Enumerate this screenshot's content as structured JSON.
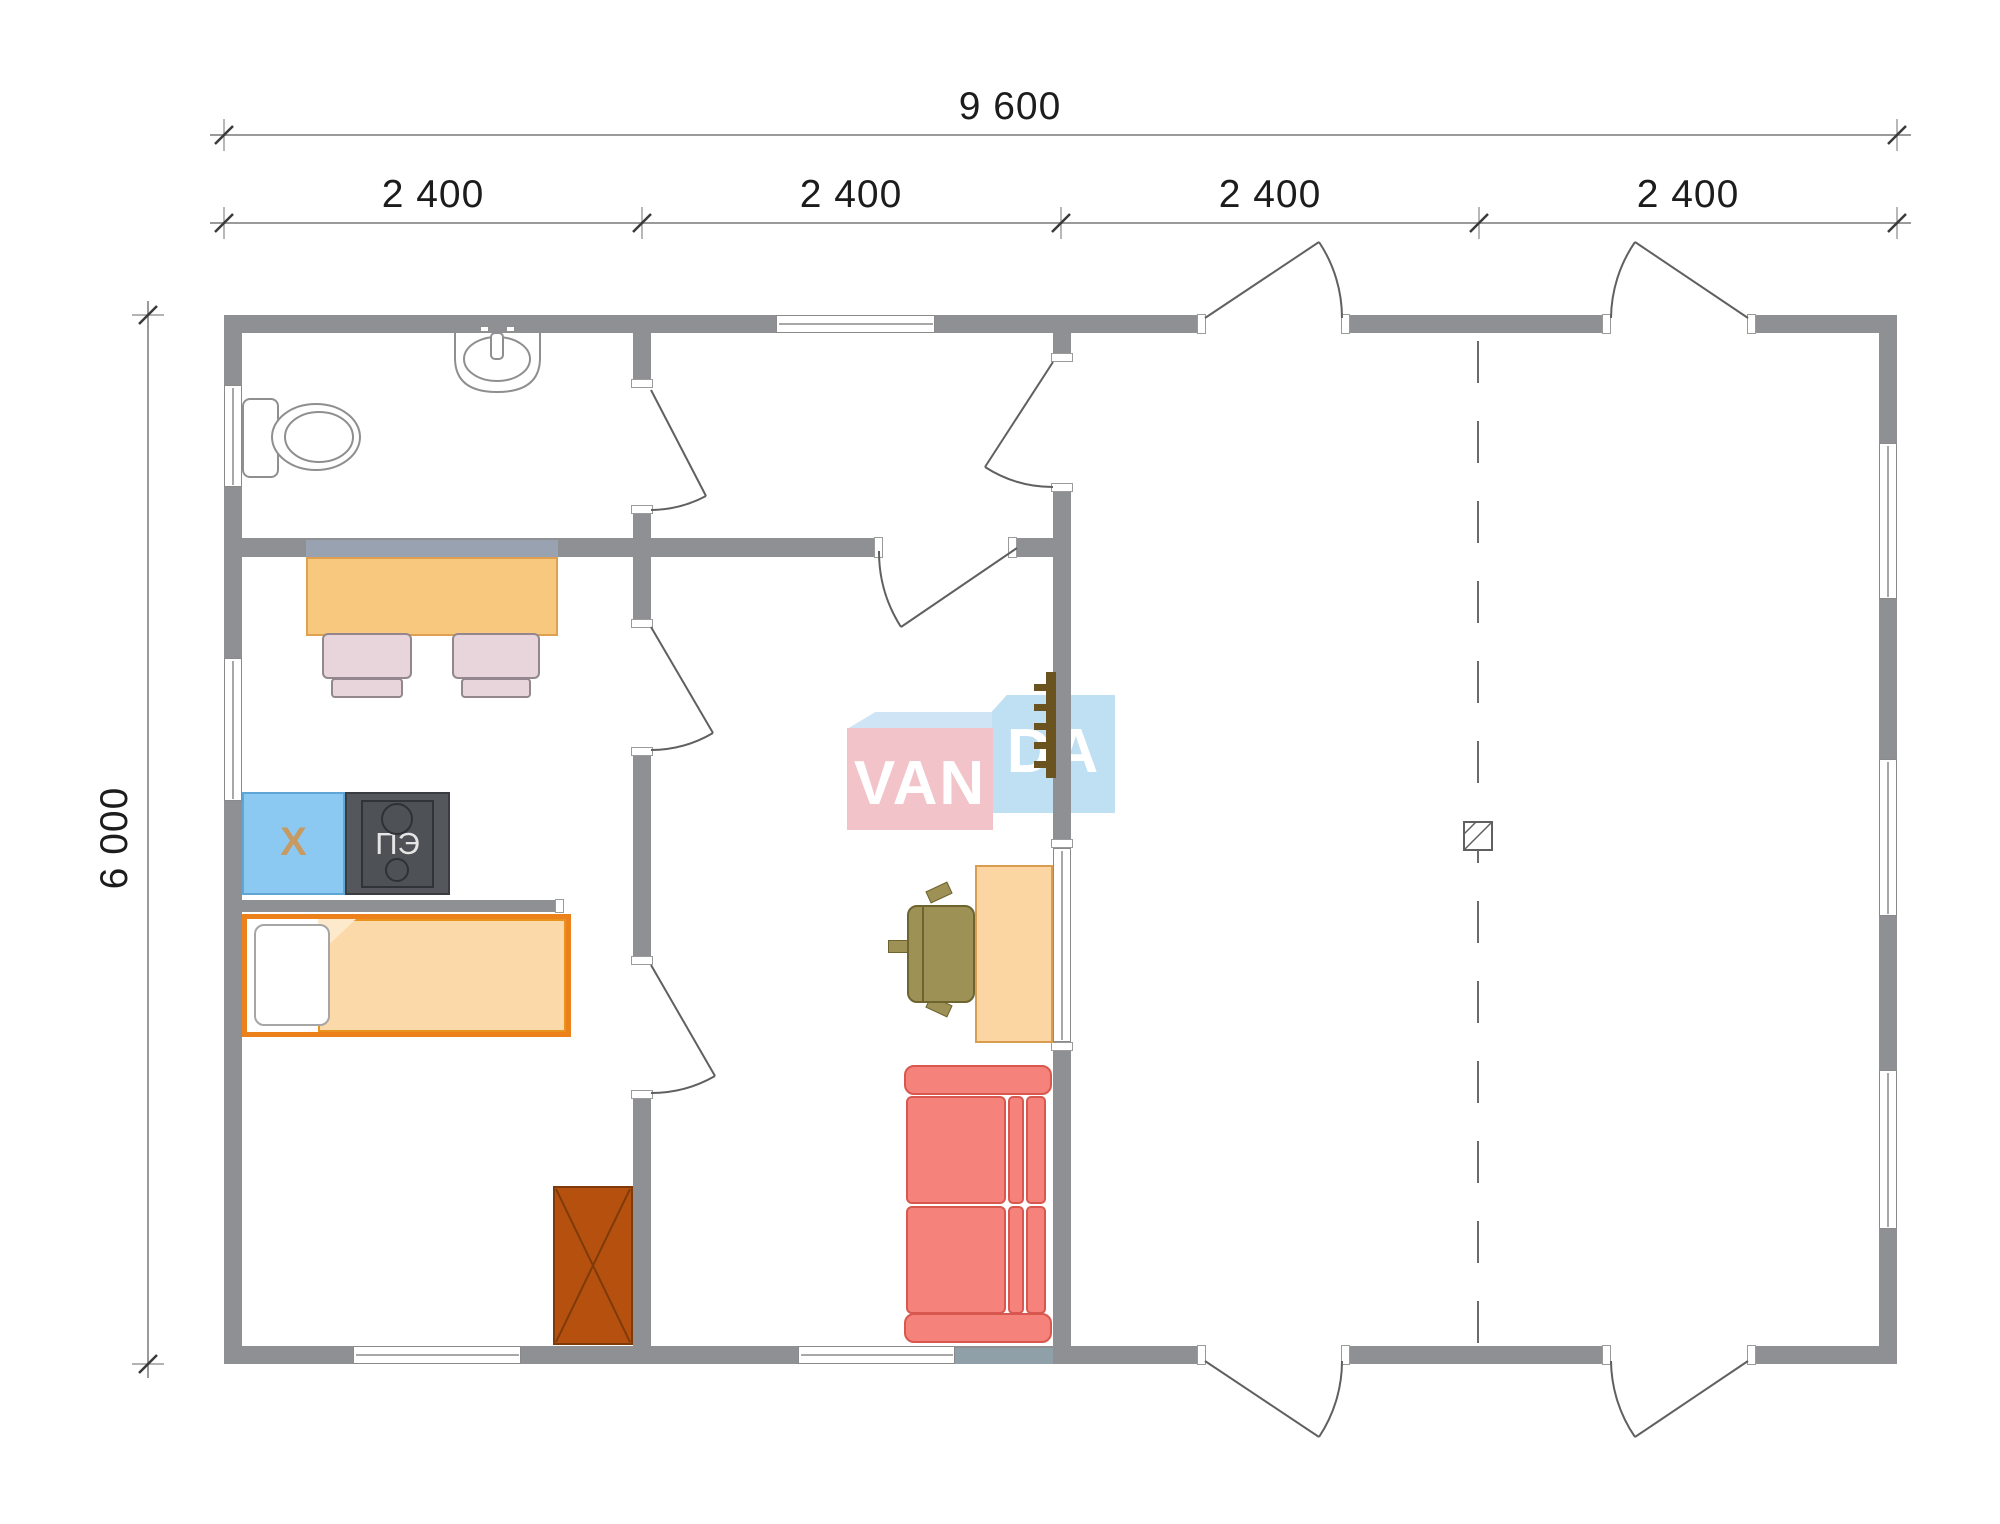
{
  "plan": {
    "type": "floor-plan",
    "dimensions": {
      "total_width_label": "9 600",
      "segment_labels": [
        "2 400",
        "2 400",
        "2 400",
        "2 400"
      ],
      "height_label": "6 000"
    },
    "logo": {
      "full": "VANDA",
      "text_left": "VAN",
      "text_right": "DA",
      "pink_color": "#F2C4C9",
      "blue_color": "#BFDFF2"
    },
    "appliances": {
      "fridge_label": "Х",
      "stove_label": "ПЭ"
    },
    "palette": {
      "wall_gray": "#8E9093",
      "table_orange": "#F9C87F",
      "chair_pink": "#E7D5DB",
      "fridge_blue": "#8CC9F2",
      "stove_dark": "#54585C",
      "bed_frame_orange": "#EC811B",
      "blanket_peach": "#FBD9A8",
      "wardrobe_brown": "#B5500E",
      "sofa_red": "#F5837B",
      "desk_peach": "#FCD6A2",
      "office_chair_olive": "#9D9156",
      "ladder_brown": "#6B531F"
    }
  }
}
